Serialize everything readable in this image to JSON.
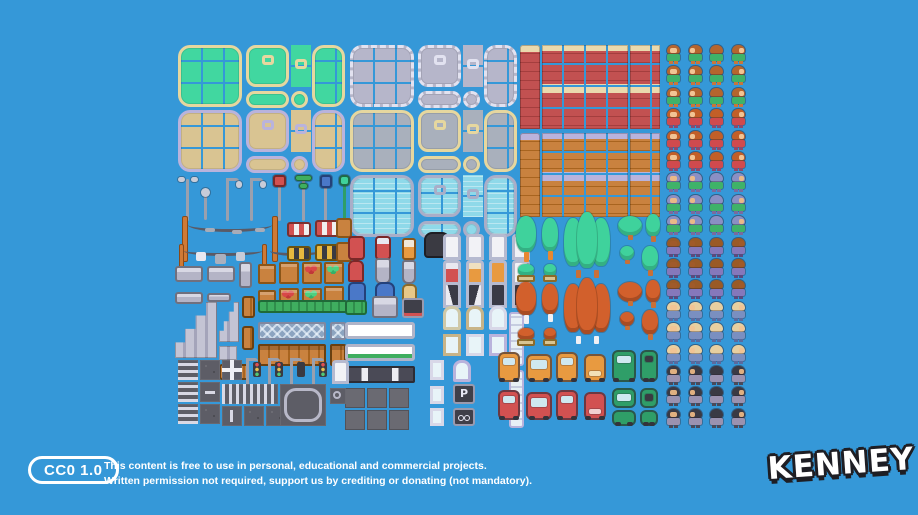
{
  "footer": {
    "license_badge": "CC0 1.0",
    "license_line1": "This content is free to use in personal, educational and commercial projects.",
    "license_line2": "Written permission not required, support us by crediting or donating (not mandatory).",
    "brand": "KENNEY"
  },
  "signs": {
    "parking": "P"
  },
  "palette": {
    "bg": "#3598d8",
    "grass": "#41d7a0",
    "sand": "#d9c492",
    "stone": "#b6b6ca",
    "stone2": "#a9b0bc",
    "water": "#8fd9e9",
    "brickred": "#c25151",
    "brickreddark": "#a43e3e",
    "cream": "#ead9ad",
    "brickorange": "#c9823f",
    "brickorangedark": "#a8641f",
    "lavender": "#b9b3dc",
    "tan": "#e6d79f",
    "wood": "#c9823f",
    "road": "#5d5d66",
    "roadline": "#d8d8e4",
    "treegreen": "#3fd29c",
    "treeorange": "#d2602c",
    "trunk": "#c87038",
    "carorange": "#e89a40",
    "carred": "#d25151",
    "cargreen": "#2f9e68"
  },
  "characters": [
    {
      "name": "boy-green-shirt",
      "hair": "#b5652e",
      "skin": "#f2c494",
      "top": "#3fb269",
      "bottom": "#c9763a"
    },
    {
      "name": "girl-red-shirt",
      "hair": "#c25f28",
      "skin": "#f2c494",
      "top": "#cf4a4e",
      "bottom": "#8a4a6e"
    },
    {
      "name": "lady-blue-hair",
      "hair": "#8a8fc4",
      "skin": "#eab988",
      "top": "#3fb269",
      "bottom": "#7a6a9e"
    },
    {
      "name": "man-dark-skin",
      "hair": "#9a5a26",
      "skin": "#a05a2a",
      "top": "#8578bb",
      "bottom": "#5a4a7e"
    },
    {
      "name": "man-blue-overalls",
      "hair": "#e8cfa0",
      "skin": "#f2c494",
      "top": "#7a8fc0",
      "bottom": "#5a6a9e"
    },
    {
      "name": "man-red-headband",
      "hair": "#3a3a44",
      "skin": "#e0b080",
      "top": "#9a92b0",
      "bottom": "#4a4a5a"
    }
  ],
  "asset_groups": [
    "grass-tileset",
    "sand-tileset",
    "stone-tileset",
    "pavement-tileset",
    "water-tileset",
    "red-brick-wall",
    "orange-brick-wall",
    "street-lamps-and-signs",
    "power-lines",
    "barriers",
    "crates-and-market-stalls",
    "benches-and-furniture",
    "trash-cans-and-mailboxes",
    "doors",
    "windows",
    "storefronts",
    "stairs",
    "fences",
    "road-tiles",
    "traffic-lights",
    "trees-green",
    "trees-autumn",
    "vehicles",
    "character-sprites"
  ]
}
